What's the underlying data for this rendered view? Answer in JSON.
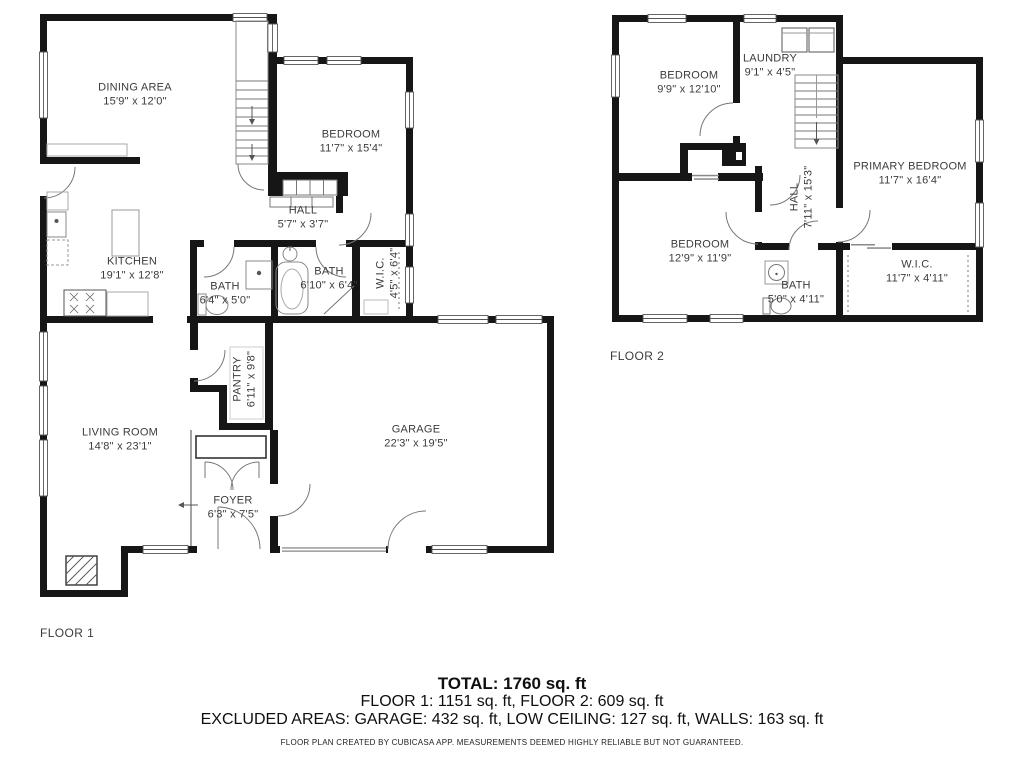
{
  "floor1": {
    "caption": "FLOOR 1",
    "rooms": {
      "dining": {
        "name": "DINING AREA",
        "dims": "15'9\" x 12'0\""
      },
      "bedroom": {
        "name": "BEDROOM",
        "dims": "11'7\" x 15'4\""
      },
      "hall": {
        "name": "HALL",
        "dims": "5'7\" x 3'7\""
      },
      "kitchen": {
        "name": "KITCHEN",
        "dims": "19'1\" x 12'8\""
      },
      "bath_small": {
        "name": "BATH",
        "dims": "6'4\" x 5'0\""
      },
      "bath_large": {
        "name": "BATH",
        "dims": "6'10\" x 6'4\""
      },
      "wic": {
        "name": "W.I.C.",
        "dims": "4'5\" x 6'4\""
      },
      "pantry": {
        "name": "PANTRY",
        "dims": "6'11\" x 9'8\""
      },
      "living_room": {
        "name": "LIVING ROOM",
        "dims": "14'8\" x 23'1\""
      },
      "foyer": {
        "name": "FOYER",
        "dims": "6'3\" x 7'5\""
      },
      "garage": {
        "name": "GARAGE",
        "dims": "22'3\" x 19'5\""
      }
    }
  },
  "floor2": {
    "caption": "FLOOR 2",
    "rooms": {
      "bedroom_top": {
        "name": "BEDROOM",
        "dims": "9'9\" x 12'10\""
      },
      "laundry": {
        "name": "LAUNDRY",
        "dims": "9'1\" x 4'5\""
      },
      "primary_bedroom": {
        "name": "PRIMARY BEDROOM",
        "dims": "11'7\" x 16'4\""
      },
      "hall": {
        "name": "HALL",
        "dims": "7'11\" x 15'3\""
      },
      "bedroom_bottom": {
        "name": "BEDROOM",
        "dims": "12'9\" x 11'9\""
      },
      "bath": {
        "name": "BATH",
        "dims": "5'0\" x 4'11\""
      },
      "wic": {
        "name": "W.I.C.",
        "dims": "11'7\" x 4'11\""
      }
    }
  },
  "summary": {
    "total": "TOTAL: 1760 sq. ft",
    "floors": "FLOOR 1: 1151 sq. ft, FLOOR 2: 609 sq. ft",
    "excluded": "EXCLUDED AREAS: GARAGE: 432 sq. ft, LOW CEILING: 127 sq. ft, WALLS: 163 sq. ft",
    "disclaimer": "FLOOR PLAN CREATED BY CUBICASA APP. MEASUREMENTS DEEMED HIGHLY RELIABLE BUT NOT GUARANTEED."
  }
}
